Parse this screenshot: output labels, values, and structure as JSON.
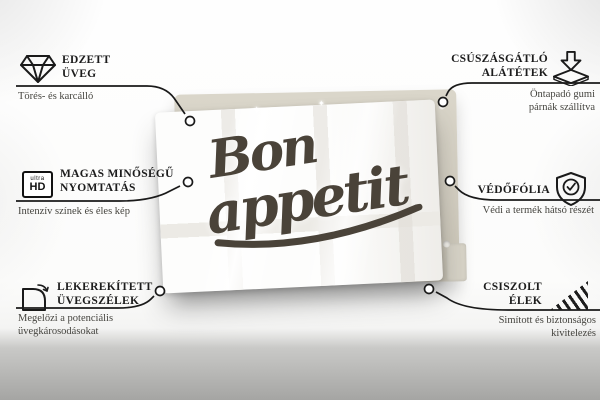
{
  "lettering": {
    "line1": "Bon",
    "line2": "appetit"
  },
  "callouts": {
    "tempered_glass": {
      "title1": "EDZETT",
      "title2": "ÜVEG",
      "sub1": "Törés- és karcálló"
    },
    "print_quality": {
      "title1": "MAGAS MINŐSÉGŰ",
      "title2": "NYOMTATÁS",
      "sub1": "Intenzív színek és éles kép"
    },
    "rounded_edges": {
      "title1": "LEKEREKÍTETT",
      "title2": "ÜVEGSZÉLEK",
      "sub1": "Megelőzi a potenciális",
      "sub2": "üvegkárosodásokat"
    },
    "anti_slip": {
      "title1": "CSÚSZÁSGÁTLÓ",
      "title2": "ALÁTÉTEK",
      "sub1": "Öntapadó gumi",
      "sub2": "párnák szállítva"
    },
    "protective_film": {
      "title1": "VÉDŐFÓLIA",
      "sub1": "Védi a termék hátsó részét"
    },
    "polished_edges": {
      "title1": "CSISZOLT",
      "title2": "ÉLEK",
      "sub1": "Simított és biztonságos",
      "sub2": "kivitelezés"
    }
  },
  "icons": {
    "ultra_hd": {
      "line1": "ultra",
      "line2": "HD"
    },
    "sparkle": "✦"
  },
  "colors": {
    "line": "#1a1a1a",
    "title_text": "#1c1c1c",
    "subtext": "#45443f",
    "board_back": "#d2cdc0",
    "glass": "#fdfdfc",
    "lettering": "#4a4339",
    "band_top": "#c9c9c7",
    "band_bottom": "#a5a5a3"
  }
}
